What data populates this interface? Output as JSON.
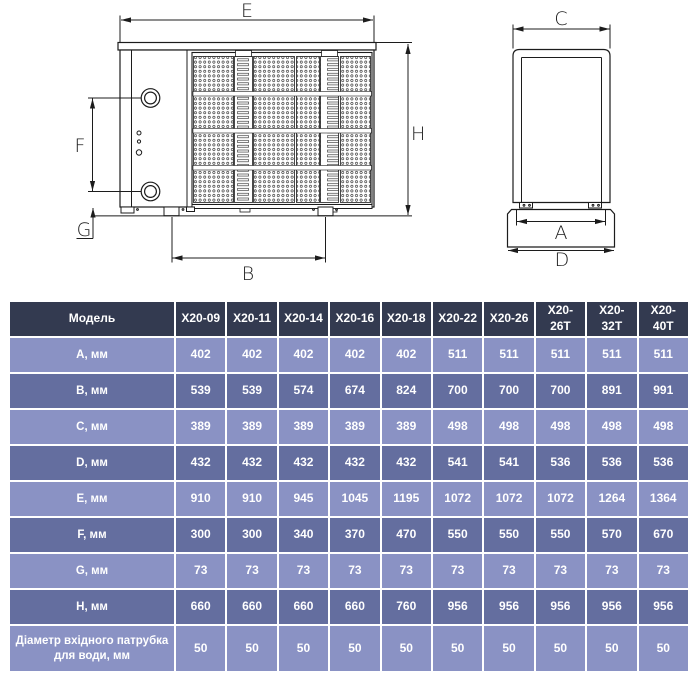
{
  "diagram": {
    "front_view": {
      "labels": {
        "e": "E",
        "h": "H",
        "f": "F",
        "g": "G",
        "b": "B"
      }
    },
    "side_view": {
      "labels": {
        "c": "C",
        "a": "A",
        "d": "D"
      }
    }
  },
  "table": {
    "header_label": "Модель",
    "models": [
      "X20-09",
      "X20-11",
      "X20-14",
      "X20-16",
      "X20-18",
      "X20-22",
      "X20-26",
      "X20-26T",
      "X20-32T",
      "X20-40T"
    ],
    "rows": [
      {
        "label": "A, мм",
        "values": [
          "402",
          "402",
          "402",
          "402",
          "402",
          "511",
          "511",
          "511",
          "511",
          "511"
        ]
      },
      {
        "label": "B, мм",
        "values": [
          "539",
          "539",
          "574",
          "674",
          "824",
          "700",
          "700",
          "700",
          "891",
          "991"
        ]
      },
      {
        "label": "C, мм",
        "values": [
          "389",
          "389",
          "389",
          "389",
          "389",
          "498",
          "498",
          "498",
          "498",
          "498"
        ]
      },
      {
        "label": "D, мм",
        "values": [
          "432",
          "432",
          "432",
          "432",
          "432",
          "541",
          "541",
          "536",
          "536",
          "536"
        ]
      },
      {
        "label": "E, мм",
        "values": [
          "910",
          "910",
          "945",
          "1045",
          "1195",
          "1072",
          "1072",
          "1072",
          "1264",
          "1364"
        ]
      },
      {
        "label": "F, мм",
        "values": [
          "300",
          "300",
          "340",
          "370",
          "470",
          "550",
          "550",
          "550",
          "570",
          "670"
        ]
      },
      {
        "label": "G, мм",
        "values": [
          "73",
          "73",
          "73",
          "73",
          "73",
          "73",
          "73",
          "73",
          "73",
          "73"
        ]
      },
      {
        "label": "H, мм",
        "values": [
          "660",
          "660",
          "660",
          "660",
          "760",
          "956",
          "956",
          "956",
          "956",
          "956"
        ]
      },
      {
        "label": "Діаметр вхідного патрубка\nдля води, мм",
        "values": [
          "50",
          "50",
          "50",
          "50",
          "50",
          "50",
          "50",
          "50",
          "50",
          "50"
        ]
      }
    ],
    "colors": {
      "header_bg": "#333a50",
      "row_light": "#8a92c4",
      "row_dark": "#646e9f",
      "grid": "#ffffff",
      "text": "#ffffff"
    }
  }
}
